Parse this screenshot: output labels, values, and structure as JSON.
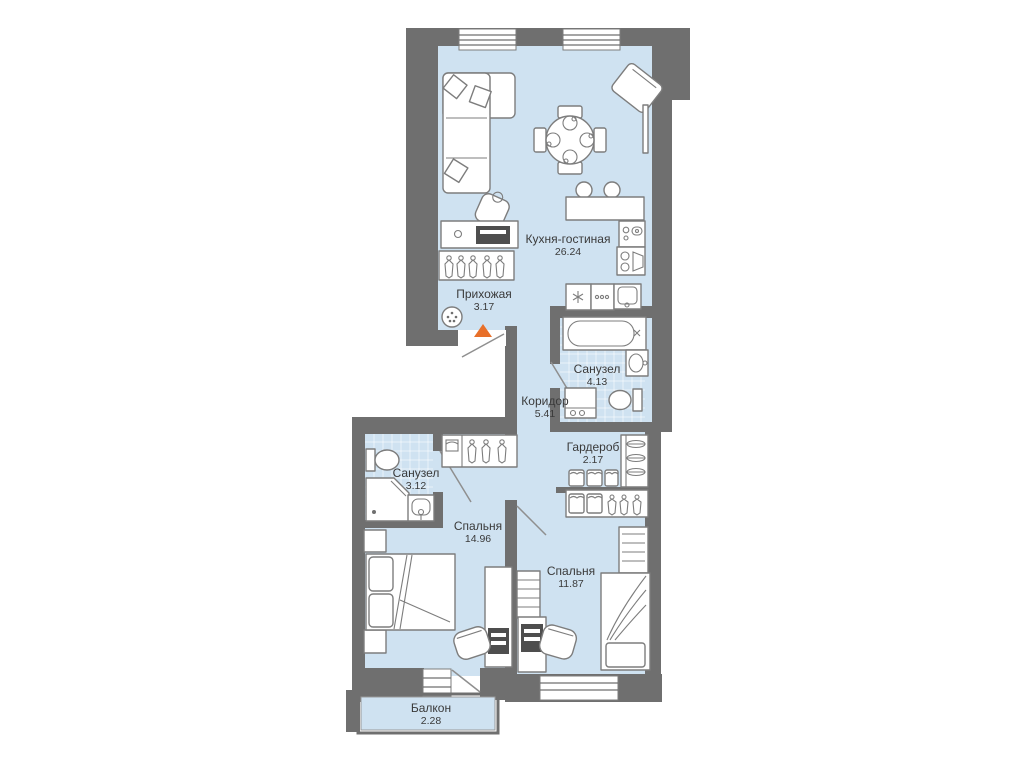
{
  "rooms": [
    {
      "name": "Кухня-гостиная",
      "area": "26.24"
    },
    {
      "name": "Прихожая",
      "area": "3.17"
    },
    {
      "name": "Санузел",
      "area": "4.13"
    },
    {
      "name": "Коридор",
      "area": "5.41"
    },
    {
      "name": "Гардероб",
      "area": "2.17"
    },
    {
      "name": "Санузел",
      "area": "3.12"
    },
    {
      "name": "Спальня",
      "area": "14.96"
    },
    {
      "name": "Спальня",
      "area": "11.87"
    },
    {
      "name": "Балкон",
      "area": "2.28"
    }
  ],
  "colors": {
    "wall": "#6f6f6f",
    "floor": "#cfe2f1",
    "furn": "#7d7d7d",
    "accent": "#e8702a",
    "text": "#3a3a3a"
  }
}
